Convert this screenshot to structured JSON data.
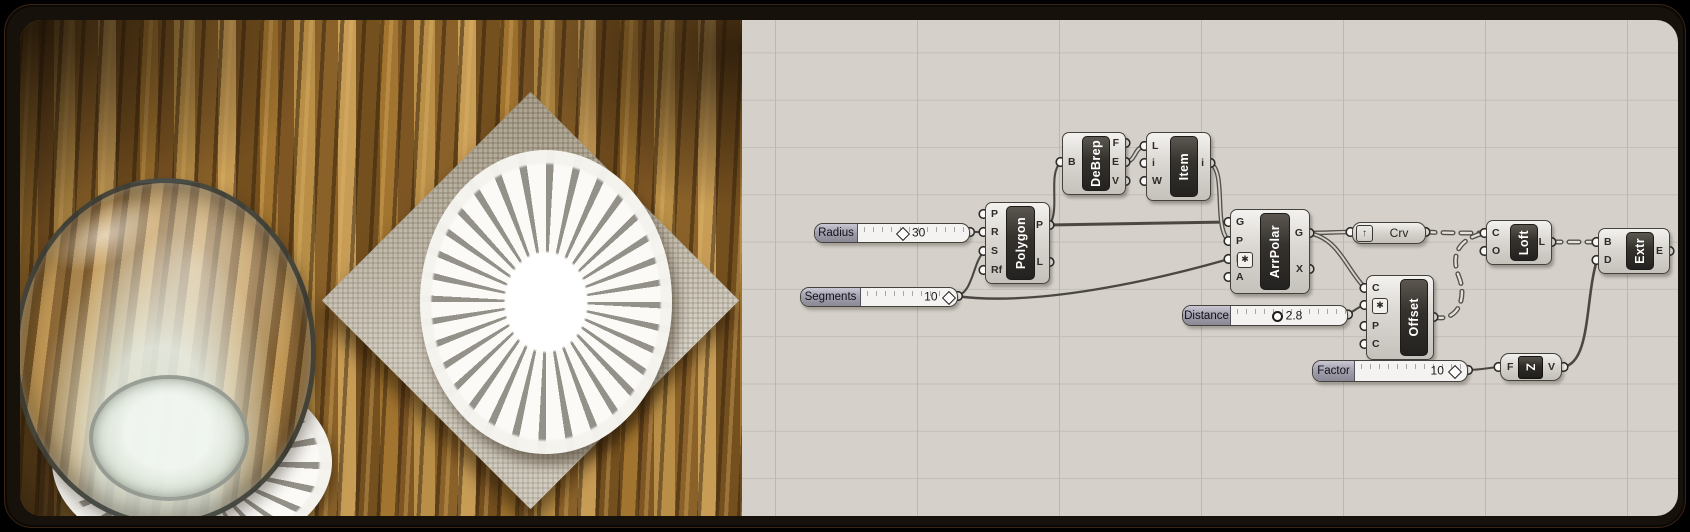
{
  "colors": {
    "canvas_bg": "#d5d1ca",
    "grid_line": "#bcb8b0",
    "node_face": "#dad7d2",
    "node_bar": "#35322d",
    "wire": "#4b4743",
    "frame": "#17110b",
    "slider_label_bg": "#a09eab",
    "wood": "#8a5f2b",
    "napkin": "#cdc6b7",
    "doily": "#ffffff"
  },
  "icons": {
    "receiver_arrow": "↑",
    "modifier_badge": "✱",
    "unit_z_glyph": "Z"
  },
  "photo": {
    "items": [
      "wood-table",
      "glass-of-water",
      "lace-coaster",
      "linen-napkin",
      "lace-doily"
    ]
  },
  "graph": {
    "sliders": [
      {
        "id": "radius",
        "label": "Radius",
        "value": "30",
        "handle": "diamond"
      },
      {
        "id": "segments",
        "label": "Segments",
        "value": "10",
        "handle": "diamond"
      },
      {
        "id": "distance",
        "label": "Distance",
        "value": "2.8",
        "handle": "circle"
      },
      {
        "id": "factor",
        "label": "Factor",
        "value": "10",
        "handle": "diamond"
      }
    ],
    "components": [
      {
        "id": "polygon",
        "title": "Polygon",
        "inputs": [
          "P",
          "R",
          "S",
          "Rf"
        ],
        "outputs": [
          "P",
          "L"
        ]
      },
      {
        "id": "debrep",
        "title": "DeBrep",
        "inputs": [
          "B"
        ],
        "outputs": [
          "F",
          "E",
          "V"
        ]
      },
      {
        "id": "item",
        "title": "Item",
        "inputs": [
          "L",
          "i",
          "W"
        ],
        "outputs": [
          "i"
        ]
      },
      {
        "id": "arrpolar",
        "title": "ArrPolar",
        "inputs": [
          "G",
          "P",
          "N",
          "A"
        ],
        "outputs": [
          "G",
          "X"
        ],
        "input_badges": [
          2
        ]
      },
      {
        "id": "offset",
        "title": "Offset",
        "inputs": [
          "C",
          "D",
          "P",
          "C"
        ],
        "outputs": [
          "C"
        ],
        "input_badges": [
          1
        ]
      },
      {
        "id": "loft",
        "title": "Loft",
        "inputs": [
          "C",
          "O"
        ],
        "outputs": [
          "L"
        ]
      },
      {
        "id": "extr",
        "title": "Extr",
        "inputs": [
          "B",
          "D"
        ],
        "outputs": [
          "E"
        ]
      },
      {
        "id": "crv",
        "title": "Crv"
      },
      {
        "id": "unitz",
        "title": "Z",
        "inputs": [
          "F"
        ],
        "outputs": [
          "V"
        ]
      }
    ],
    "connections": [
      {
        "from": "Radius",
        "to": "Polygon.R",
        "kind": "item"
      },
      {
        "from": "Segments",
        "to": "Polygon.S",
        "kind": "item"
      },
      {
        "from": "Segments",
        "to": "ArrPolar.N",
        "kind": "item"
      },
      {
        "from": "Polygon.P",
        "to": "DeBrep.B",
        "kind": "item"
      },
      {
        "from": "Polygon.P",
        "to": "ArrPolar.G",
        "kind": "item"
      },
      {
        "from": "DeBrep.E",
        "to": "Item.L",
        "kind": "list"
      },
      {
        "from": "Item.i",
        "to": "ArrPolar.P",
        "kind": "list"
      },
      {
        "from": "ArrPolar.G",
        "to": "Crv",
        "kind": "list"
      },
      {
        "from": "ArrPolar.G",
        "to": "Offset.C",
        "kind": "list"
      },
      {
        "from": "Distance",
        "to": "Offset.D",
        "kind": "item"
      },
      {
        "from": "Crv",
        "to": "Loft.C",
        "kind": "tree"
      },
      {
        "from": "Offset.C",
        "to": "Loft.C",
        "kind": "tree"
      },
      {
        "from": "Loft.L",
        "to": "Extr.B",
        "kind": "tree"
      },
      {
        "from": "Factor",
        "to": "UnitZ.F",
        "kind": "item"
      },
      {
        "from": "UnitZ.V",
        "to": "Extr.D",
        "kind": "item"
      }
    ]
  }
}
